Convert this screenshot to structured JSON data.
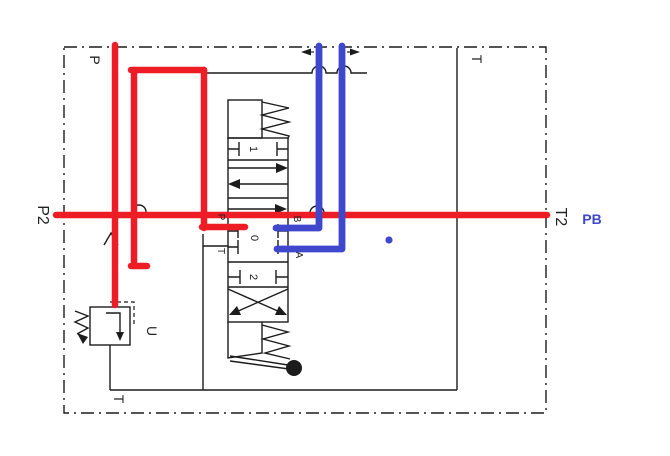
{
  "diagram": {
    "boundary": {
      "label_p_top": "P",
      "label_t_top_right": "T",
      "label_t_bottom": "T",
      "label_p2_left": "P2",
      "label_t2_right": "T2"
    },
    "valve": {
      "position_1": "1",
      "position_0": "0",
      "position_2": "2",
      "port_p": "P",
      "port_t": "T",
      "port_b": "B",
      "port_a": "A"
    },
    "relief_valve": {
      "label_u": "U"
    },
    "annotations": {
      "label_pb": "PB"
    },
    "colors": {
      "red": "#ee1c24",
      "blue": "#3f48cc",
      "line": "#1c1c1c"
    }
  }
}
